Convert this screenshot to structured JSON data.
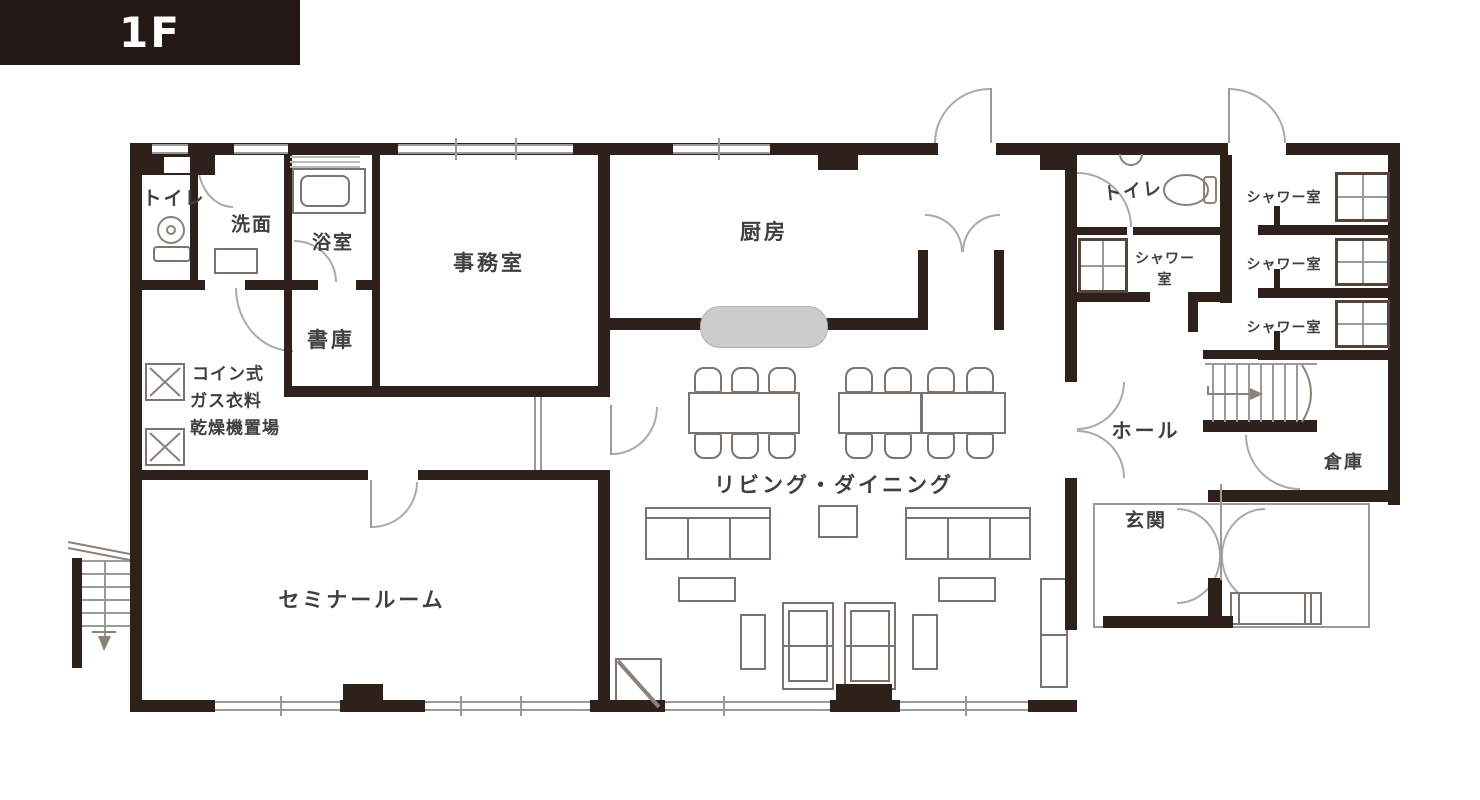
{
  "header": {
    "floor_label": "1F"
  },
  "palette": {
    "canvas_bg": "#ffffff",
    "header_bg": "#231815",
    "wall": "#2e211b",
    "line": "#9a9a9a",
    "furniture_line": "#7a736e",
    "grid_line": "#55443c",
    "counter_fill": "#cccccc",
    "text": "#3f3f3f"
  },
  "rooms": {
    "toilet_left": {
      "label": "トイレ"
    },
    "washroom": {
      "label": "洗面"
    },
    "bathroom": {
      "label": "浴室"
    },
    "office": {
      "label": "事務室"
    },
    "archive": {
      "label": "書庫"
    },
    "laundry": {
      "line1": "コイン式",
      "line2": "ガス衣料",
      "line3": "乾燥機置場"
    },
    "seminar_room": {
      "label": "セミナールーム"
    },
    "kitchen": {
      "label": "厨房"
    },
    "living_dining": {
      "label": "リビング・ダイニング"
    },
    "toilet_right": {
      "label": "トイレ"
    },
    "shower_left": {
      "line1": "シャワー",
      "line2": "室"
    },
    "shower_1": {
      "label": "シャワー室"
    },
    "shower_2": {
      "label": "シャワー室"
    },
    "shower_3": {
      "label": "シャワー室"
    },
    "hall": {
      "label": "ホール"
    },
    "storage": {
      "label": "倉庫"
    },
    "entrance": {
      "label": "玄関"
    }
  }
}
